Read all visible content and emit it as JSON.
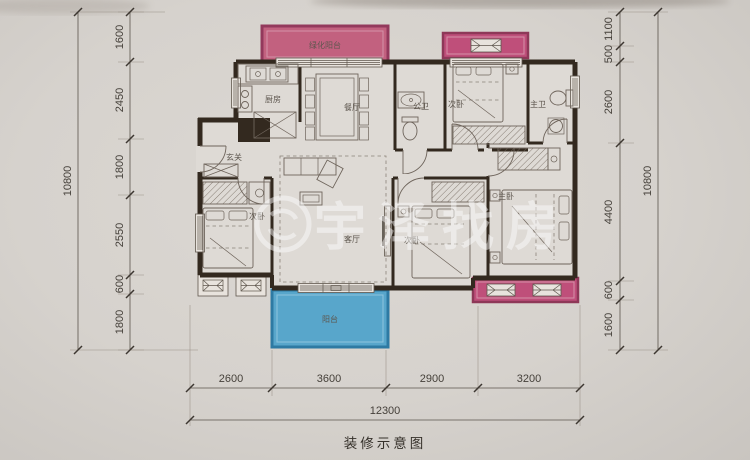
{
  "watermark": {
    "brand": "宇泽找房"
  },
  "caption": "装修示意图",
  "rooms": {
    "green_balcony": "绿化阳台",
    "kitchen": "厨房",
    "dining": "餐厅",
    "public_bath": "公卫",
    "bedroom_top": "次卧",
    "master_bath": "主卫",
    "entry": "玄关",
    "bedroom_left": "次卧",
    "living": "客厅",
    "bedroom_mid": "次卧",
    "master_bedroom": "主卧",
    "balcony": "阳台"
  },
  "dimensions": {
    "left": {
      "total": "10800",
      "segments": [
        "1600",
        "2450",
        "1800",
        "2550",
        "600",
        "1800"
      ]
    },
    "right": {
      "total": "10800",
      "segments": [
        "1100",
        "500",
        "2600",
        "4400",
        "600",
        "1600"
      ]
    },
    "bottom": {
      "total": "12300",
      "segments": [
        "2600",
        "3600",
        "2900",
        "3200"
      ]
    }
  },
  "colors": {
    "wall": "#33291f",
    "balcony_pink": "#c2617f",
    "bay_pink": "#bf4f7a",
    "balcony_blue": "#58a6cb",
    "paper": "#d8d4cf"
  }
}
